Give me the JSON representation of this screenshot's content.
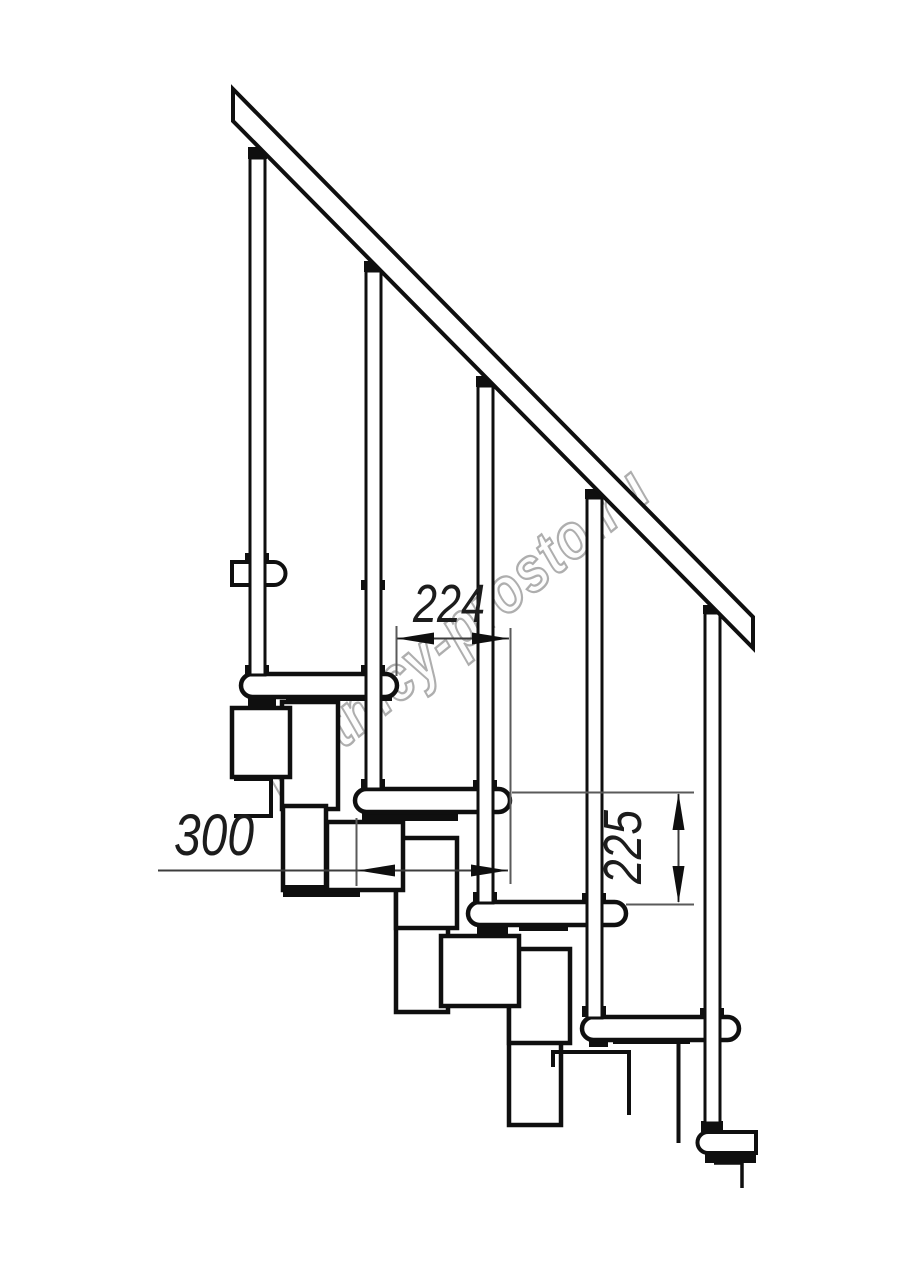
{
  "page": {
    "background": "#ffffff",
    "line_color": "#0f0f0f",
    "dim_line_color": "#5a5a5a"
  },
  "watermark": {
    "text": "lestnicy-prosto.ru",
    "stroke_color": "#aeaeae"
  },
  "drawing": {
    "subject": "modular-staircase-side-elevation",
    "dimensions": {
      "going": "224",
      "tread_depth": "300",
      "rise": "225"
    }
  }
}
